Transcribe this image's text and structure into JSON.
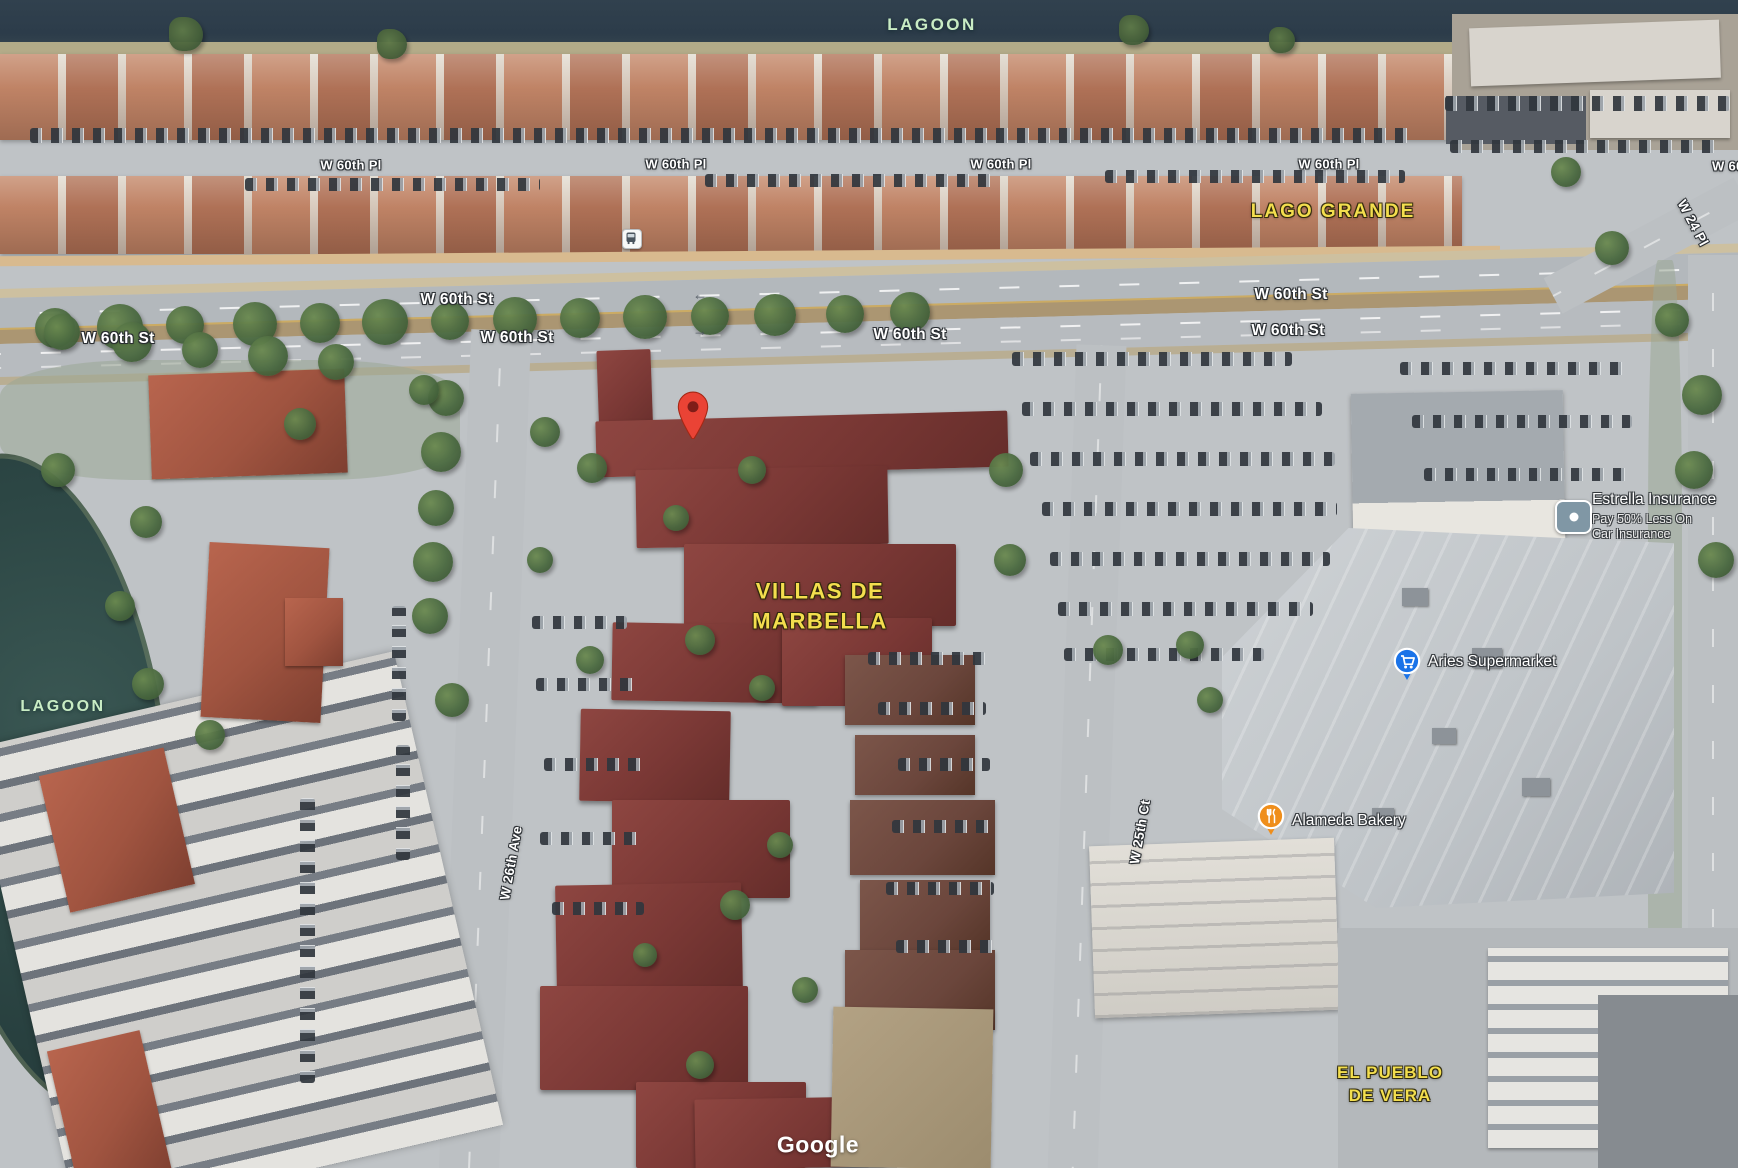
{
  "colors": {
    "pin_red": "#EA4335",
    "aries_blue": "#1a73e8",
    "alameda_orange": "#ef8e1b",
    "street_label": "#ffffff",
    "area_label": "#f3de4e",
    "water_label": "#c9ecc4"
  },
  "labels": {
    "street_pl": [
      {
        "text": "W 60th Pl"
      },
      {
        "text": "W 60th Pl"
      },
      {
        "text": "W 60th Pl"
      },
      {
        "text": "W 60th Pl"
      },
      {
        "text": "W 60th Pl"
      }
    ],
    "street_st": [
      {
        "text": "W 60th St"
      },
      {
        "text": "W 60th St"
      },
      {
        "text": "W 60th St"
      },
      {
        "text": "W 60th St"
      },
      {
        "text": "W 60th St"
      },
      {
        "text": "W 60th St"
      }
    ],
    "vertical": [
      {
        "text": "W 26th Ave"
      },
      {
        "text": "W 25th Ct"
      },
      {
        "text": "W 24 Pl"
      }
    ],
    "area": {
      "lago_grande": "LAGO GRANDE",
      "villas_line1": "VILLAS DE",
      "villas_line2": "MARBELLA",
      "pueblo_line1": "EL PUEBLO",
      "pueblo_line2": "DE VERA"
    },
    "water": {
      "top": "LAGOON",
      "left": "LAGOON"
    }
  },
  "pois": {
    "estrella": {
      "title": "Estrella Insurance",
      "subtitle_line1": "Pay 50% Less On",
      "subtitle_line2": "Car Insurance",
      "icon": "ad-badge-icon"
    },
    "aries": {
      "title": "Aries Supermarket",
      "icon": "shopping-cart-icon"
    },
    "alameda": {
      "title": "Alameda Bakery",
      "icon": "restaurant-icon"
    }
  },
  "markers": {
    "destination_pin": {
      "icon": "map-pin-icon"
    },
    "bus_stop": {
      "icon": "bus-icon"
    }
  },
  "road_arrows": [
    {
      "glyph": "←"
    },
    {
      "glyph": "→"
    }
  ],
  "watermark": {
    "text": "Google"
  }
}
